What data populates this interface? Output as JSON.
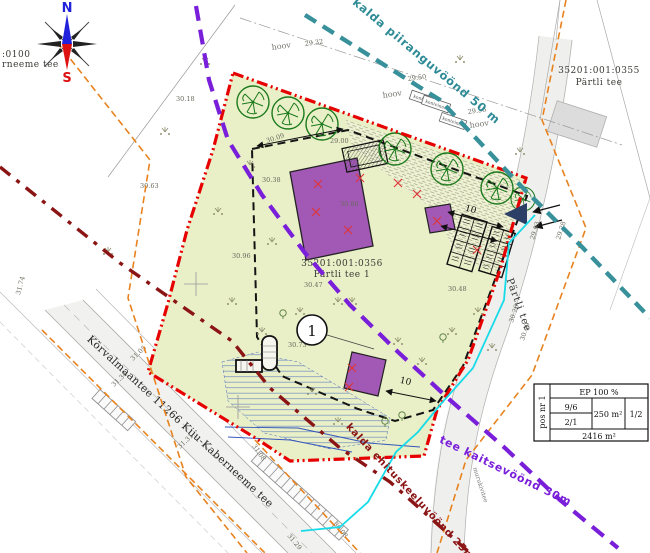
{
  "compass": {
    "north": "N",
    "south": "S"
  },
  "corner_note": {
    "line1": ":0100",
    "line2": "rneeme tee"
  },
  "parcels": {
    "neighbor_ne": {
      "cadastral": "35201:001:0355",
      "name": "Pärtli tee"
    },
    "site": {
      "cadastral": "35201:001:0356",
      "name": "Pärtli tee 1",
      "pos_number": "1"
    }
  },
  "zones": {
    "shore_limit": {
      "label": "kalda piiranguvöönd 50 m",
      "color": "#2e8b96"
    },
    "road_protection": {
      "label": "tee kaitsevöönd 30m",
      "color": "#7a1fd9"
    },
    "shore_building_ban": {
      "label": "kalda ehituskeeluvöönd 25m",
      "color": "#8b1414"
    }
  },
  "roads": {
    "main": "Kõrvalmaantee 11266 Kiiu-Kaberneeme tee",
    "side": "Pärtli tee",
    "surface_note": "murukivitee"
  },
  "yard_labels": [
    "hoov",
    "hoov",
    "hoov"
  ],
  "container_label": "konteiner",
  "dimensions": {
    "d1": "10",
    "d2": "10"
  },
  "elevations": [
    "29.32",
    "29.50",
    "29.56",
    "30.18",
    "30.63",
    "30.38",
    "30.86",
    "30.96",
    "30.47",
    "30.73",
    "30.48",
    "29.00",
    "30.09",
    "31.05",
    "31.34",
    "31.31",
    "31.08",
    "29.03",
    "30.26",
    "30.49",
    "29.28",
    "30.08",
    "31.29",
    "31.74"
  ],
  "info_table": {
    "pos": "pos nr 1",
    "ep": "EP 100 %",
    "storeys": "9/6",
    "r2": "2/1",
    "area_building": "250 m²",
    "ratio": "1/2",
    "area_plot": "2416 m²"
  },
  "colors": {
    "parcel_fill": "#e9efc7",
    "boundary_red": "#e60000",
    "zone_purple": "#7a1fd9",
    "zone_teal": "#38909a",
    "zone_maroon": "#8b1414",
    "road_land_orange": "#e8821e",
    "utility_cyan": "#17dbe8",
    "building_purple": "#a259b5",
    "access_navy": "#2c3f66"
  }
}
